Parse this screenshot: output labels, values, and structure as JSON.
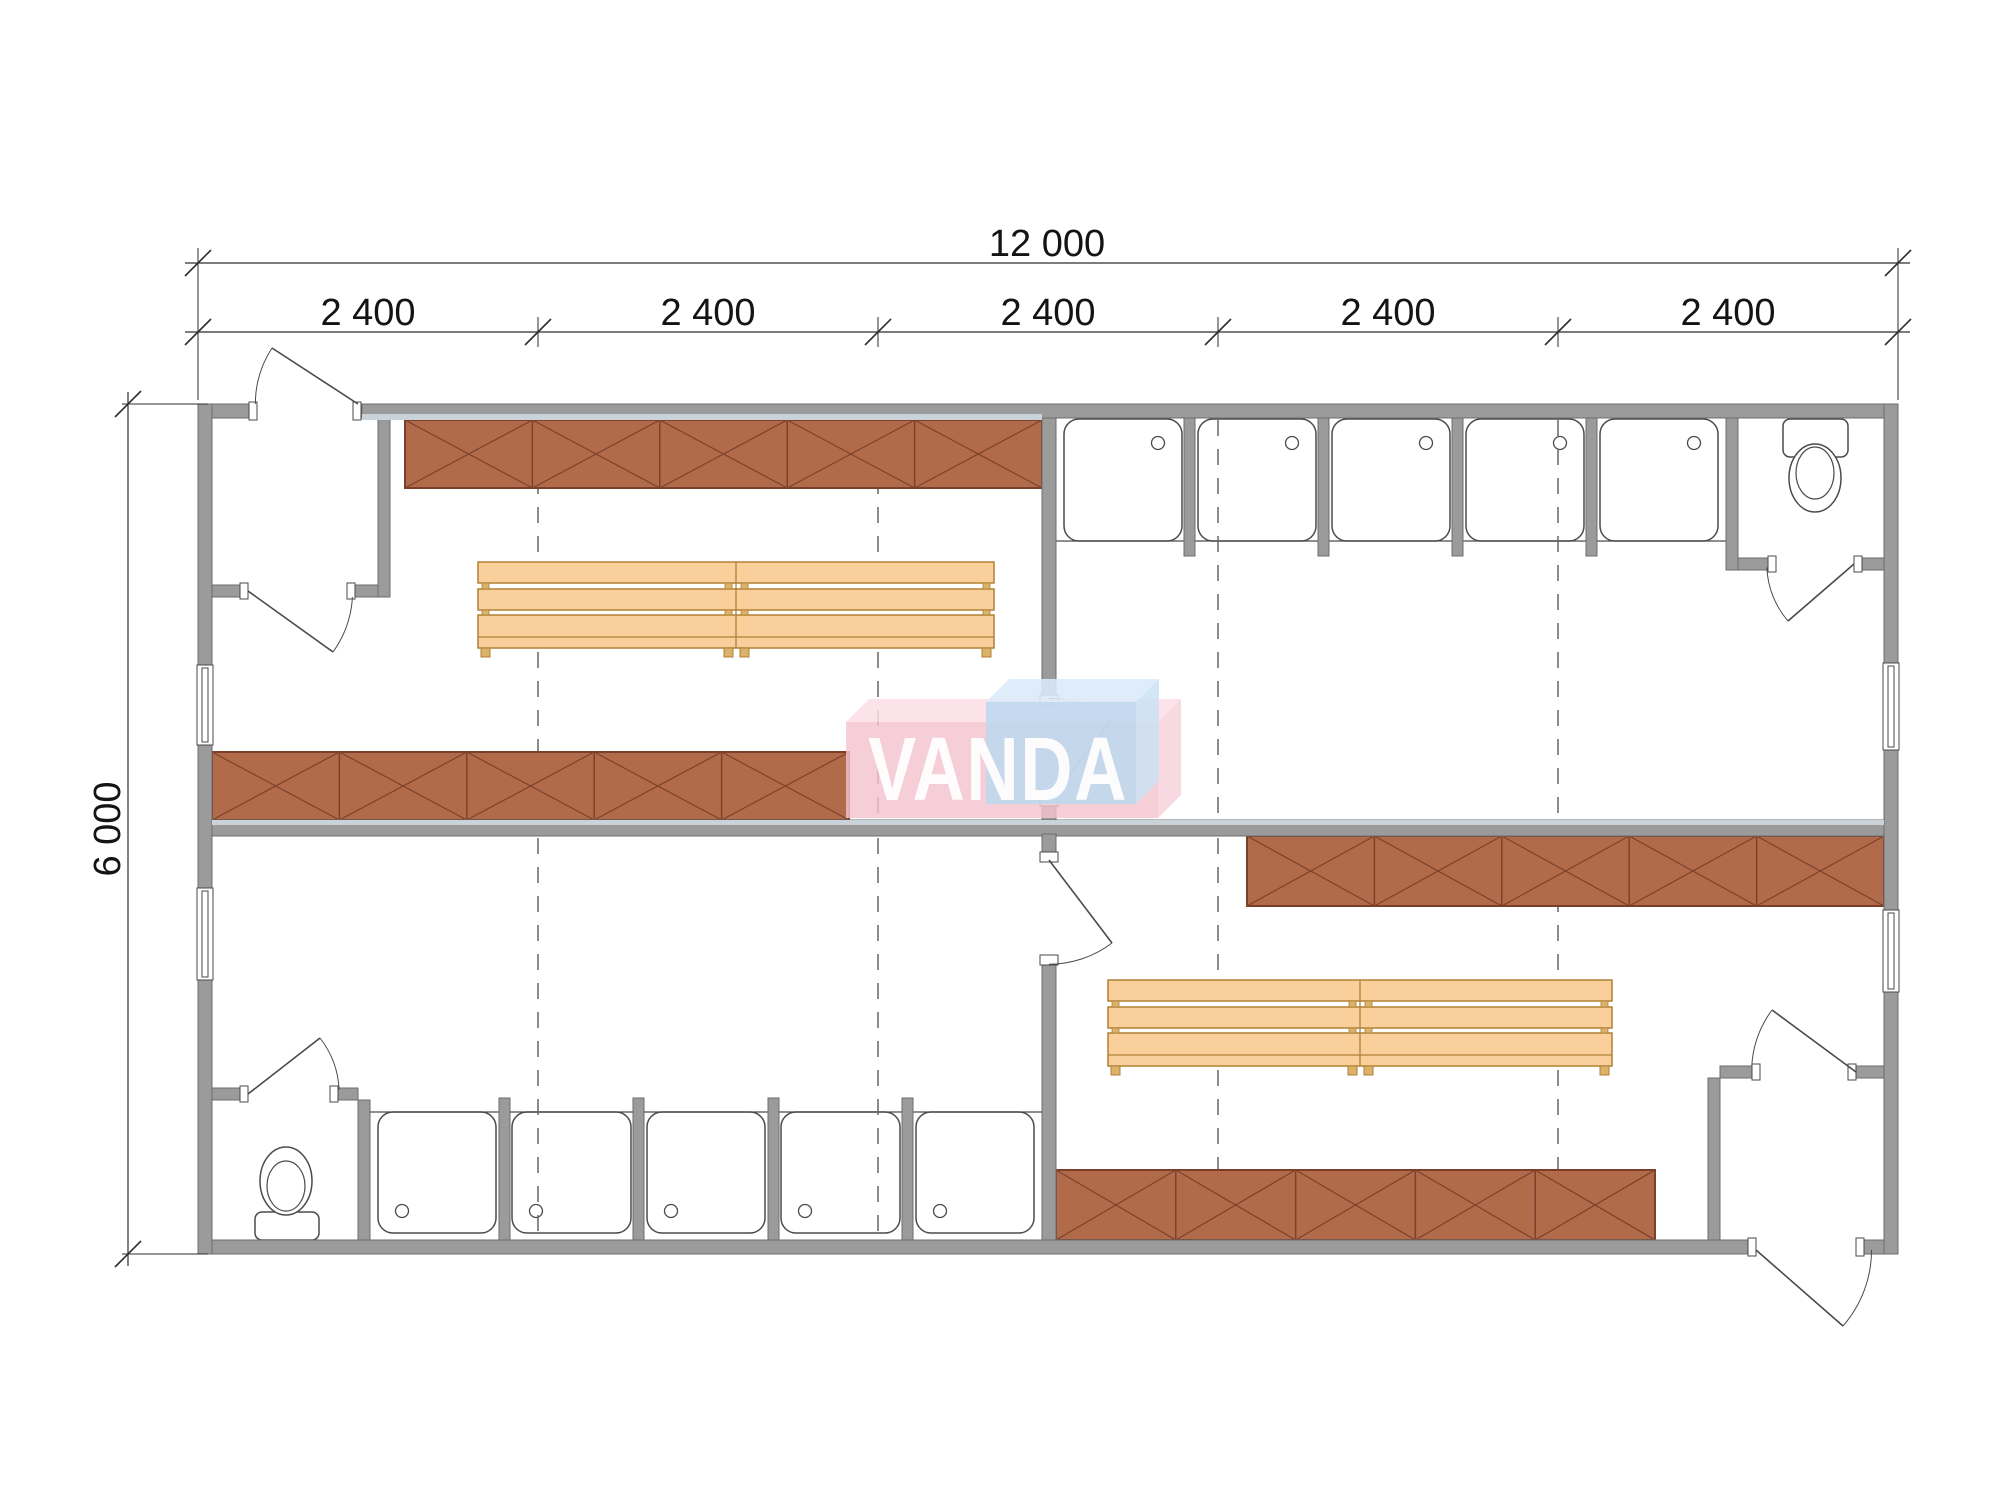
{
  "meta": {
    "type": "architectural-floor-plan",
    "building": "modular sanitary container 12000 x 6000"
  },
  "labels": {
    "total_width": "12 000",
    "modules": [
      "2 400",
      "2 400",
      "2 400",
      "2 400",
      "2 400"
    ],
    "total_height": "6 000",
    "watermark": "VANDA"
  },
  "colors": {
    "wall": "#9b9b9b",
    "wallEdge": "#6e6e6e",
    "line": "#4a4a4a",
    "strip": "#c9d3d9",
    "locker": "#b26b4a",
    "lockerEdge": "#7c412a",
    "bench": "#f9d09b",
    "benchEdge": "#b08035",
    "foot": "#dcb169",
    "dash": "#666666",
    "dim": "#2e2e2e",
    "logoPinkFront": "rgba(244,195,206,0.82)",
    "logoPinkTop": "rgba(250,222,229,0.85)",
    "logoPinkSide": "rgba(247,209,218,0.82)",
    "logoBlueFront": "rgba(187,216,238,0.85)",
    "logoBlueTop": "rgba(218,235,248,0.88)",
    "logoBlueSide": "rgba(203,226,243,0.85)"
  },
  "plan": {
    "wallRects": [
      [
        198,
        404,
        52,
        14
      ],
      [
        362,
        404,
        1536,
        14
      ],
      [
        198,
        1240,
        1550,
        14
      ],
      [
        1864,
        1240,
        34,
        14
      ],
      [
        198,
        404,
        14,
        261
      ],
      [
        198,
        745,
        14,
        143
      ],
      [
        198,
        980,
        14,
        274
      ],
      [
        1884,
        404,
        14,
        259
      ],
      [
        1884,
        750,
        14,
        160
      ],
      [
        1884,
        992,
        14,
        262
      ],
      [
        212,
        820,
        1672,
        16
      ],
      [
        1042,
        418,
        14,
        277
      ],
      [
        1042,
        806,
        14,
        14
      ],
      [
        1042,
        834,
        14,
        18
      ],
      [
        1042,
        965,
        14,
        275
      ],
      [
        378,
        418,
        12,
        179
      ],
      [
        212,
        585,
        28,
        12
      ],
      [
        355,
        585,
        23,
        12
      ],
      [
        1726,
        418,
        12,
        152
      ],
      [
        1738,
        558,
        30,
        12
      ],
      [
        1862,
        558,
        22,
        12
      ],
      [
        212,
        1088,
        28,
        12
      ],
      [
        338,
        1088,
        20,
        12
      ],
      [
        358,
        1100,
        12,
        140
      ],
      [
        1720,
        1066,
        32,
        12
      ],
      [
        1856,
        1066,
        28,
        12
      ],
      [
        1708,
        1078,
        12,
        162
      ],
      [
        1184,
        418,
        11,
        138
      ],
      [
        1318,
        418,
        11,
        138
      ],
      [
        1452,
        418,
        11,
        138
      ],
      [
        1586,
        418,
        11,
        138
      ],
      [
        499,
        1098,
        11,
        142
      ],
      [
        633,
        1098,
        11,
        142
      ],
      [
        768,
        1098,
        11,
        142
      ],
      [
        902,
        1098,
        11,
        142
      ]
    ],
    "strips": [
      [
        362,
        414,
        680,
        6
      ],
      [
        212,
        820,
        1672,
        5
      ]
    ],
    "jambs": [
      [
        249,
        402,
        8,
        18
      ],
      [
        353,
        402,
        8,
        18
      ],
      [
        240,
        583,
        8,
        16
      ],
      [
        347,
        583,
        8,
        16
      ],
      [
        1768,
        556,
        8,
        16
      ],
      [
        1854,
        556,
        8,
        16
      ],
      [
        240,
        1086,
        8,
        16
      ],
      [
        330,
        1086,
        8,
        16
      ],
      [
        1752,
        1064,
        8,
        16
      ],
      [
        1848,
        1064,
        8,
        16
      ],
      [
        1748,
        1238,
        8,
        18
      ],
      [
        1856,
        1238,
        8,
        18
      ],
      [
        1040,
        695,
        18,
        10
      ],
      [
        1040,
        796,
        18,
        10
      ],
      [
        1040,
        852,
        18,
        10
      ],
      [
        1040,
        955,
        18,
        10
      ]
    ],
    "windows": [
      [
        197,
        665,
        16,
        80
      ],
      [
        197,
        888,
        16,
        92
      ],
      [
        1883,
        663,
        16,
        87
      ],
      [
        1883,
        910,
        16,
        82
      ]
    ],
    "showerTrays": [
      [
        1064,
        419,
        118,
        122,
        1158,
        443
      ],
      [
        1198,
        419,
        118,
        122,
        1292,
        443
      ],
      [
        1332,
        419,
        118,
        122,
        1426,
        443
      ],
      [
        1466,
        419,
        118,
        122,
        1560,
        443
      ],
      [
        1600,
        419,
        118,
        122,
        1694,
        443
      ],
      [
        378,
        1112,
        118,
        121,
        402,
        1211
      ],
      [
        512,
        1112,
        119,
        121,
        536,
        1211
      ],
      [
        647,
        1112,
        118,
        121,
        671,
        1211
      ],
      [
        781,
        1112,
        119,
        121,
        805,
        1211
      ],
      [
        916,
        1112,
        118,
        121,
        940,
        1211
      ]
    ],
    "showerRowLines": [
      [
        1056,
        541,
        1726
      ],
      [
        370,
        1112,
        1042
      ]
    ],
    "toilets": [
      {
        "tank": [
          1783,
          419,
          65,
          38
        ],
        "bowl": [
          1815,
          478,
          26,
          34
        ],
        "seat": [
          1815,
          473,
          19,
          26
        ],
        "btns": [
          [
            1804,
            411,
            5,
            6
          ],
          [
            1811,
            411,
            5,
            6
          ],
          [
            1818,
            411,
            5,
            6
          ]
        ]
      },
      {
        "tank": [
          255,
          1212,
          64,
          28
        ],
        "bowl": [
          286,
          1181,
          26,
          34
        ],
        "seat": [
          286,
          1186,
          19,
          25
        ],
        "btns": [
          [
            277,
            1240,
            5,
            6
          ],
          [
            284,
            1240,
            5,
            6
          ],
          [
            291,
            1240,
            5,
            6
          ]
        ]
      }
    ],
    "dashes": [
      [
        538,
        420,
        816
      ],
      [
        878,
        420,
        816
      ],
      [
        1218,
        420,
        816
      ],
      [
        1558,
        420,
        816
      ],
      [
        538,
        838,
        1238
      ],
      [
        878,
        838,
        1238
      ],
      [
        1218,
        838,
        1238
      ],
      [
        1558,
        838,
        1238
      ]
    ],
    "lockers": [
      {
        "x": 405,
        "y": 420,
        "w": 637,
        "h": 68,
        "n": 5
      },
      {
        "x": 212,
        "y": 752,
        "w": 637,
        "h": 68,
        "n": 5
      },
      {
        "x": 1247,
        "y": 836,
        "w": 637,
        "h": 70,
        "n": 5
      },
      {
        "x": 1056,
        "y": 1170,
        "w": 599,
        "h": 70,
        "n": 5
      }
    ],
    "benches": [
      {
        "x": 478,
        "y": 562,
        "w": 516,
        "joint": 736
      },
      {
        "x": 1108,
        "y": 980,
        "w": 504,
        "joint": 1360
      }
    ],
    "doors": [
      {
        "h": [
          358,
          404
        ],
        "t": [
          272,
          348
        ],
        "a": [
          253,
          404
        ],
        "sweep": 1
      },
      {
        "h": [
          248,
          591
        ],
        "t": [
          333,
          652
        ],
        "a": [
          350,
          597
        ],
        "sweep": 1
      },
      {
        "h": [
          1049,
          801
        ],
        "t": [
          1112,
          720
        ],
        "a": [
          1049,
          703
        ],
        "sweep": 1
      },
      {
        "h": [
          1049,
          860
        ],
        "t": [
          1112,
          943
        ],
        "a": [
          1049,
          957
        ],
        "sweep": 0
      },
      {
        "h": [
          1854,
          564
        ],
        "t": [
          1788,
          621
        ],
        "a": [
          1776,
          567
        ],
        "sweep": 0
      },
      {
        "h": [
          248,
          1094
        ],
        "t": [
          320,
          1038
        ],
        "a": [
          332,
          1090
        ],
        "sweep": 0
      },
      {
        "h": [
          1856,
          1072
        ],
        "t": [
          1772,
          1010
        ],
        "a": [
          1758,
          1066
        ],
        "sweep": 1
      },
      {
        "h": [
          1756,
          1250
        ],
        "t": [
          1843,
          1326
        ],
        "a": [
          1858,
          1250
        ],
        "sweep": 1
      }
    ],
    "dims": {
      "lines": [
        [
          185,
          263,
          1910,
          263
        ],
        [
          185,
          332,
          1910,
          332
        ],
        [
          128,
          392,
          128,
          1266
        ]
      ],
      "ext": [
        [
          198,
          250,
          198,
          400
        ],
        [
          1898,
          250,
          1898,
          400
        ],
        [
          122,
          404,
          208,
          404
        ],
        [
          122,
          1254,
          208,
          1254
        ]
      ],
      "ticks": [
        {
          "x": 198,
          "y": 263,
          "w": 1
        },
        {
          "x": 1898,
          "y": 263,
          "w": 1
        },
        {
          "x": 198,
          "y": 332,
          "w": 1
        },
        {
          "x": 538,
          "y": 332,
          "w": 1
        },
        {
          "x": 878,
          "y": 332,
          "w": 1
        },
        {
          "x": 1218,
          "y": 332,
          "w": 1
        },
        {
          "x": 1558,
          "y": 332,
          "w": 1
        },
        {
          "x": 1898,
          "y": 332,
          "w": 1
        },
        {
          "x": 128,
          "y": 404,
          "w": 0
        },
        {
          "x": 128,
          "y": 1254,
          "w": 0
        }
      ]
    },
    "logo": {
      "pinkFront": [
        846,
        722,
        312,
        96
      ],
      "pinkTop": [
        [
          846,
          722
        ],
        [
          869,
          699
        ],
        [
          1181,
          699
        ],
        [
          1158,
          722
        ]
      ],
      "pinkSide": [
        [
          1158,
          722
        ],
        [
          1181,
          699
        ],
        [
          1181,
          795
        ],
        [
          1158,
          818
        ]
      ],
      "blueFront": [
        986,
        702,
        150,
        102
      ],
      "blueTop": [
        [
          986,
          702
        ],
        [
          1009,
          679
        ],
        [
          1159,
          679
        ],
        [
          1136,
          702
        ]
      ],
      "blueSide": [
        [
          1136,
          702
        ],
        [
          1159,
          679
        ],
        [
          1159,
          781
        ],
        [
          1136,
          804
        ]
      ]
    }
  }
}
